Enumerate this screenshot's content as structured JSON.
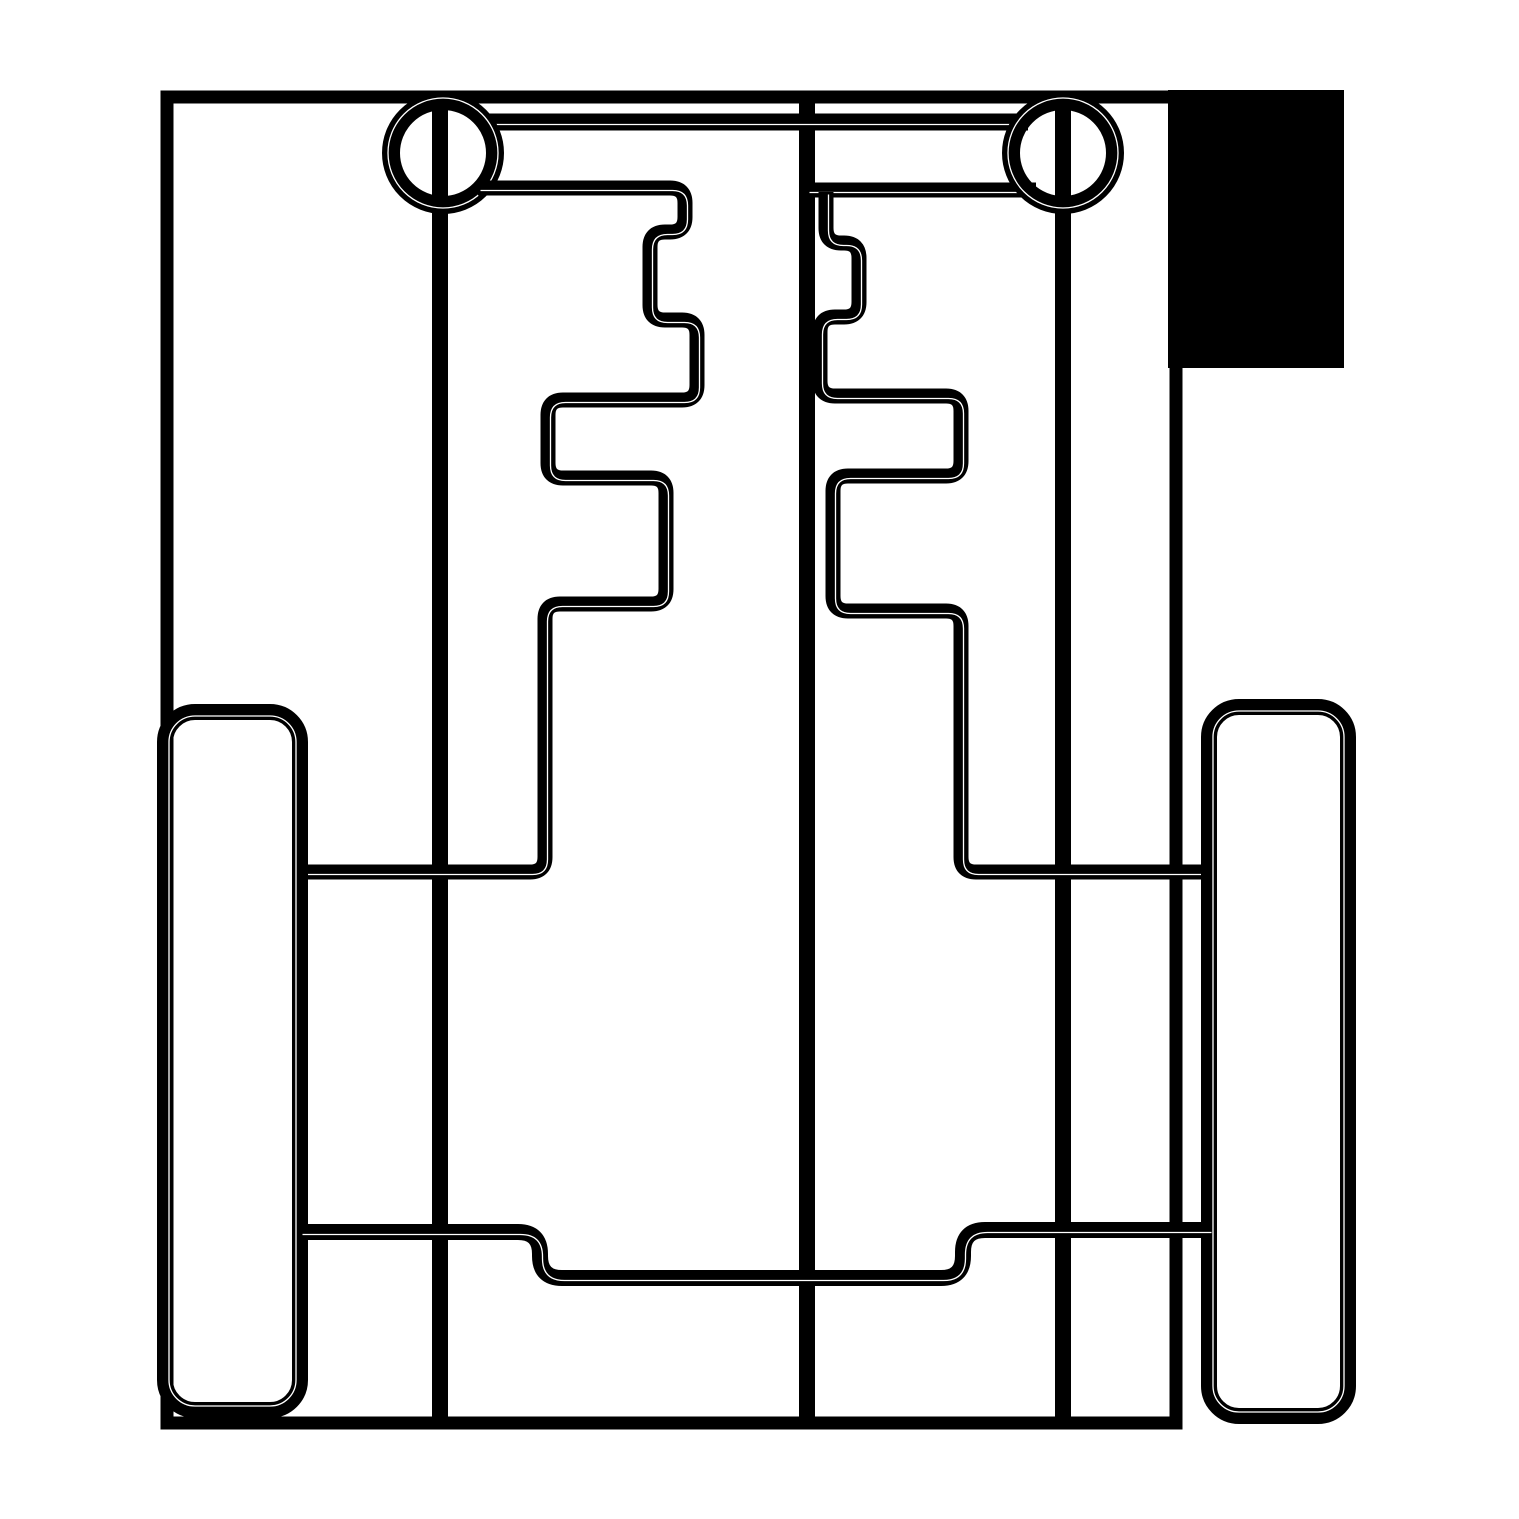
{
  "canvas": {
    "width": 1519,
    "height": 1519,
    "background": "#ffffff",
    "line_color": "#000000",
    "hairline_color": "#ffffff"
  },
  "shapes": [
    {
      "type": "rect-fill",
      "name": "filled-corner-block",
      "x": 1168,
      "y": 90,
      "w": 176,
      "h": 278
    },
    {
      "type": "rect",
      "name": "outer-frame",
      "x": 167,
      "y": 97,
      "w": 1009,
      "h": 1326,
      "rx": 0,
      "sw": 13,
      "hair": "none"
    },
    {
      "type": "line",
      "name": "left-axle-line",
      "x1": 440,
      "y1": 97,
      "x2": 440,
      "y2": 1423,
      "sw": 16,
      "hair": "none"
    },
    {
      "type": "line",
      "name": "center-line",
      "x1": 807,
      "y1": 97,
      "x2": 807,
      "y2": 1423,
      "sw": 16,
      "hair": "none"
    },
    {
      "type": "line",
      "name": "right-axle-line",
      "x1": 1063,
      "y1": 97,
      "x2": 1063,
      "y2": 1423,
      "sw": 16,
      "hair": "none"
    },
    {
      "type": "line",
      "name": "top-bar-upper-edge",
      "x1": 480,
      "y1": 122,
      "x2": 1028,
      "y2": 122,
      "sw": 17,
      "hair": "offset"
    },
    {
      "type": "line",
      "name": "top-bar-lower-edge-right",
      "x1": 807,
      "y1": 190,
      "x2": 1036,
      "y2": 190,
      "sw": 15,
      "hair": "offset"
    },
    {
      "type": "ring",
      "name": "left-hub-circle",
      "cx": 443,
      "cy": 153,
      "r": 52,
      "sw": 18,
      "hairR": 55
    },
    {
      "type": "ring",
      "name": "right-hub-circle",
      "cx": 1063,
      "cy": 153,
      "r": 52,
      "sw": 18,
      "hairR": 55
    },
    {
      "type": "poly",
      "name": "left-step-profile",
      "r": 15,
      "sw": 15,
      "hair": "offset",
      "points": [
        [
          478,
          188
        ],
        [
          685,
          188
        ],
        [
          685,
          232
        ],
        [
          650,
          232
        ],
        [
          650,
          320
        ],
        [
          697,
          320
        ],
        [
          697,
          400
        ],
        [
          548,
          400
        ],
        [
          548,
          478
        ],
        [
          666,
          478
        ],
        [
          666,
          604
        ],
        [
          545,
          604
        ],
        [
          545,
          872
        ],
        [
          300,
          872
        ]
      ]
    },
    {
      "type": "poly",
      "name": "right-step-profile",
      "r": 15,
      "sw": 15,
      "hair": "offset",
      "points": [
        [
          826,
          192
        ],
        [
          826,
          243
        ],
        [
          859,
          243
        ],
        [
          859,
          317
        ],
        [
          820,
          317
        ],
        [
          820,
          396
        ],
        [
          961,
          396
        ],
        [
          961,
          476
        ],
        [
          833,
          476
        ],
        [
          833,
          611
        ],
        [
          961,
          611
        ],
        [
          961,
          872
        ],
        [
          1209,
          872
        ]
      ]
    },
    {
      "type": "rect",
      "name": "left-wheel",
      "x": 165,
      "y": 712,
      "w": 135,
      "h": 698,
      "rx": 30,
      "sw": 16,
      "hair": "inset"
    },
    {
      "type": "rect",
      "name": "right-wheel",
      "x": 1209,
      "y": 707,
      "w": 139,
      "h": 709,
      "rx": 30,
      "sw": 16,
      "hair": "inset"
    },
    {
      "type": "poly",
      "name": "lower-cross-member",
      "r": 22,
      "sw": 16,
      "hair": "offset",
      "points": [
        [
          300,
          1232
        ],
        [
          540,
          1232
        ],
        [
          540,
          1278
        ],
        [
          963,
          1278
        ],
        [
          963,
          1230
        ],
        [
          1209,
          1230
        ]
      ]
    }
  ]
}
